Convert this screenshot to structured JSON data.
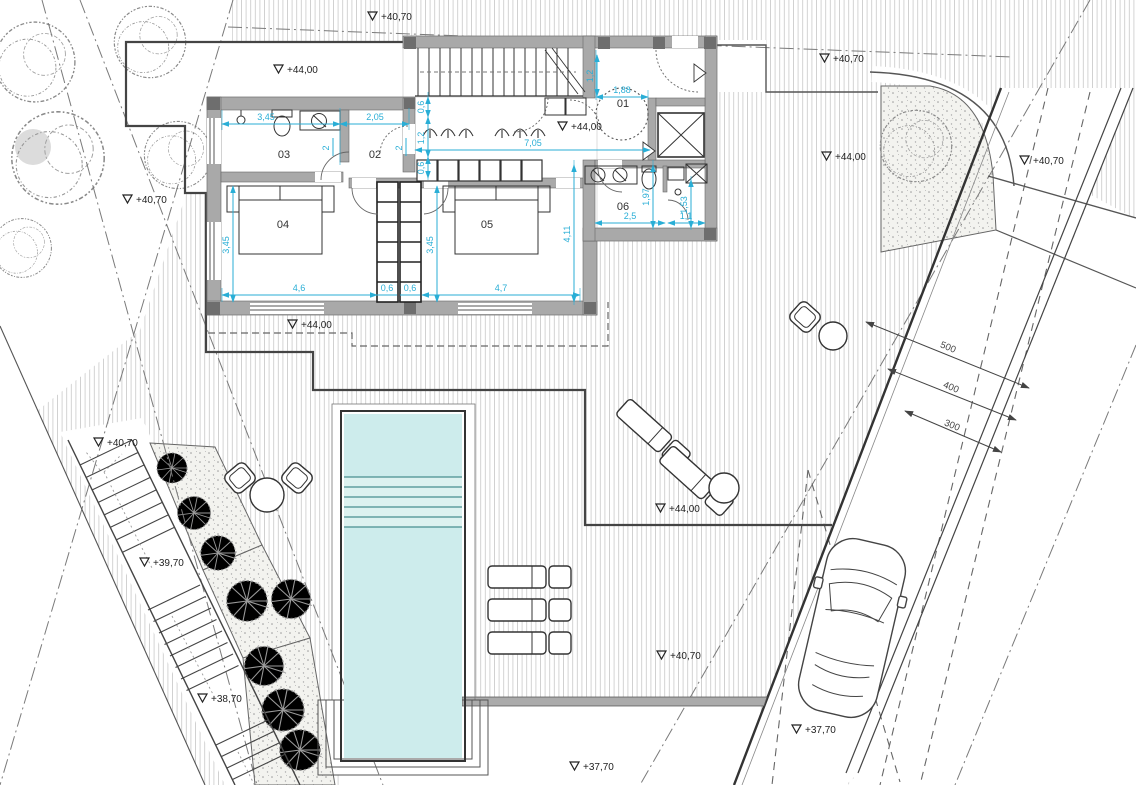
{
  "drawing_type": "architectural floor / site plan",
  "colors": {
    "pool_water": "#cdecec",
    "pool_step_band": "#ddf2f0",
    "dimension_cyan": "#29aed6",
    "wall_fill": "#a9a9a9",
    "column_fill": "#6e6e6e",
    "hatch_line": "#c8c8c8",
    "outline": "#3a3a3a"
  },
  "rooms": [
    {
      "label": "01",
      "x": 623,
      "y": 107
    },
    {
      "label": "02",
      "x": 375,
      "y": 158
    },
    {
      "label": "03",
      "x": 284,
      "y": 158
    },
    {
      "label": "04",
      "x": 283,
      "y": 228
    },
    {
      "label": "05",
      "x": 487,
      "y": 228
    },
    {
      "label": "06",
      "x": 623,
      "y": 210
    }
  ],
  "elevation_markers": [
    {
      "label": "+40,70",
      "x": 368,
      "y": 12
    },
    {
      "label": "+44,00",
      "x": 274,
      "y": 65
    },
    {
      "label": "+40,70",
      "x": 820,
      "y": 54
    },
    {
      "label": "+44,00",
      "x": 558,
      "y": 122
    },
    {
      "label": "+44,00",
      "x": 822,
      "y": 152
    },
    {
      "label": "+40,70",
      "x": 1020,
      "y": 156
    },
    {
      "label": "+40,70",
      "x": 123,
      "y": 195
    },
    {
      "label": "+44,00",
      "x": 288,
      "y": 320
    },
    {
      "label": "+40,70",
      "x": 94,
      "y": 438
    },
    {
      "label": "+39,70",
      "x": 140,
      "y": 558
    },
    {
      "label": "+44,00",
      "x": 656,
      "y": 504
    },
    {
      "label": "+40,70",
      "x": 657,
      "y": 651
    },
    {
      "label": "+38,70",
      "x": 198,
      "y": 694
    },
    {
      "label": "+37,70",
      "x": 792,
      "y": 725
    },
    {
      "label": "+37,70",
      "x": 570,
      "y": 762
    }
  ],
  "dimensions_cyan": [
    {
      "label": "3,45",
      "x": 266,
      "y": 120,
      "rot": 0
    },
    {
      "label": "2,05",
      "x": 375,
      "y": 120,
      "rot": 0
    },
    {
      "label": "7,05",
      "x": 533,
      "y": 146,
      "rot": 0
    },
    {
      "label": "1,88",
      "x": 622,
      "y": 93,
      "rot": 0
    },
    {
      "label": "0,6",
      "x": 424,
      "y": 107,
      "rot": -90
    },
    {
      "label": "1,2",
      "x": 424,
      "y": 138,
      "rot": -90
    },
    {
      "label": "0,6",
      "x": 424,
      "y": 168,
      "rot": -90
    },
    {
      "label": "1,2",
      "x": 593,
      "y": 76,
      "rot": -90
    },
    {
      "label": "3,45",
      "x": 229,
      "y": 245,
      "rot": -90
    },
    {
      "label": "3,45",
      "x": 433,
      "y": 245,
      "rot": -90
    },
    {
      "label": "4,11",
      "x": 570,
      "y": 234,
      "rot": -90
    },
    {
      "label": "4,6",
      "x": 299,
      "y": 291,
      "rot": 0
    },
    {
      "label": "0,6",
      "x": 387,
      "y": 291,
      "rot": 0
    },
    {
      "label": "0,6",
      "x": 410,
      "y": 291,
      "rot": 0
    },
    {
      "label": "4,7",
      "x": 501,
      "y": 291,
      "rot": 0
    },
    {
      "label": "2,5",
      "x": 630,
      "y": 219,
      "rot": 0
    },
    {
      "label": "1,1",
      "x": 686,
      "y": 219,
      "rot": 0
    },
    {
      "label": "1,97",
      "x": 649,
      "y": 197,
      "rot": -90
    },
    {
      "label": "1,53",
      "x": 687,
      "y": 205,
      "rot": -90
    },
    {
      "label": "2",
      "x": 329,
      "y": 148,
      "rot": -90
    },
    {
      "label": "2",
      "x": 402,
      "y": 148,
      "rot": -90
    }
  ],
  "dimensions_dark": [
    {
      "label": "500",
      "x": 947,
      "y": 350,
      "rot": 22
    },
    {
      "label": "400",
      "x": 950,
      "y": 390,
      "rot": 22
    },
    {
      "label": "300",
      "x": 951,
      "y": 428,
      "rot": 22
    }
  ]
}
